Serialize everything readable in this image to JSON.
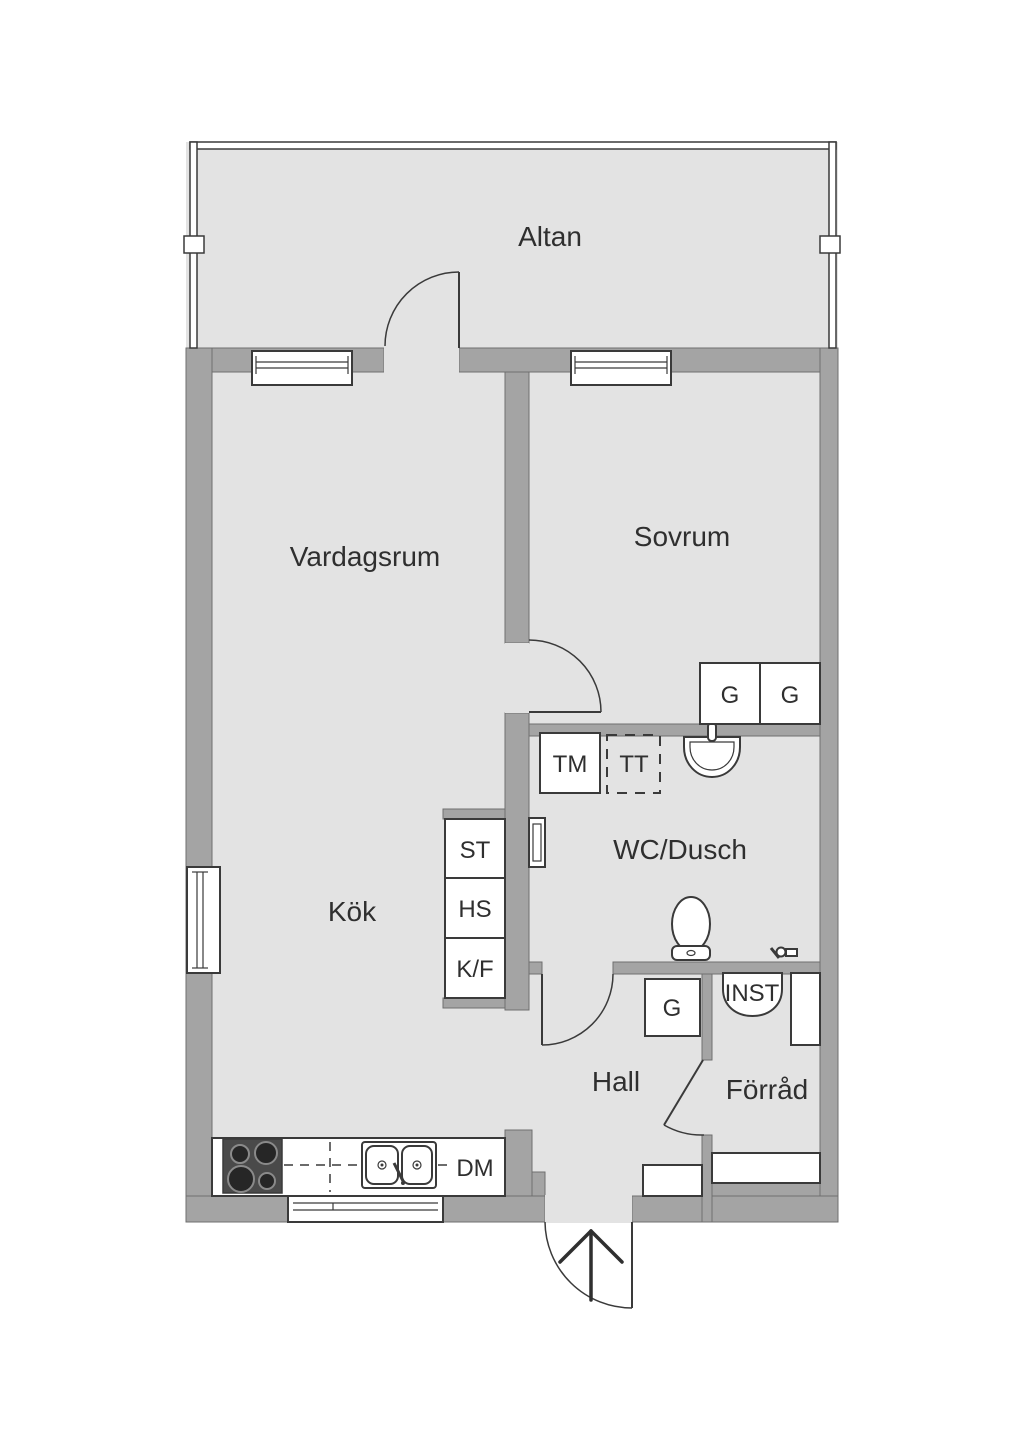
{
  "colors": {
    "wall": "#a4a4a4",
    "wall_edge": "#6f6f6f",
    "floor": "#e3e3e3",
    "outline": "#3a3a3a",
    "text": "#2f2f2f",
    "stove": "#4a4a4a",
    "burner": "#262626"
  },
  "rooms": {
    "altan": {
      "label": "Altan"
    },
    "vardagsrum": {
      "label": "Vardagsrum"
    },
    "sovrum": {
      "label": "Sovrum",
      "wardrobe_left": "G",
      "wardrobe_right": "G"
    },
    "wc_dusch": {
      "label": "WC/Dusch",
      "washing_machine": "TM",
      "tumble_dryer": "TT"
    },
    "kok": {
      "label": "Kök",
      "tall_unit_top": "ST",
      "tall_unit_mid": "HS",
      "tall_unit_bottom": "K/F",
      "dishwasher": "DM"
    },
    "hall": {
      "label": "Hall",
      "wardrobe": "G"
    },
    "forrad": {
      "label": "Förråd",
      "installation": "INST"
    }
  }
}
